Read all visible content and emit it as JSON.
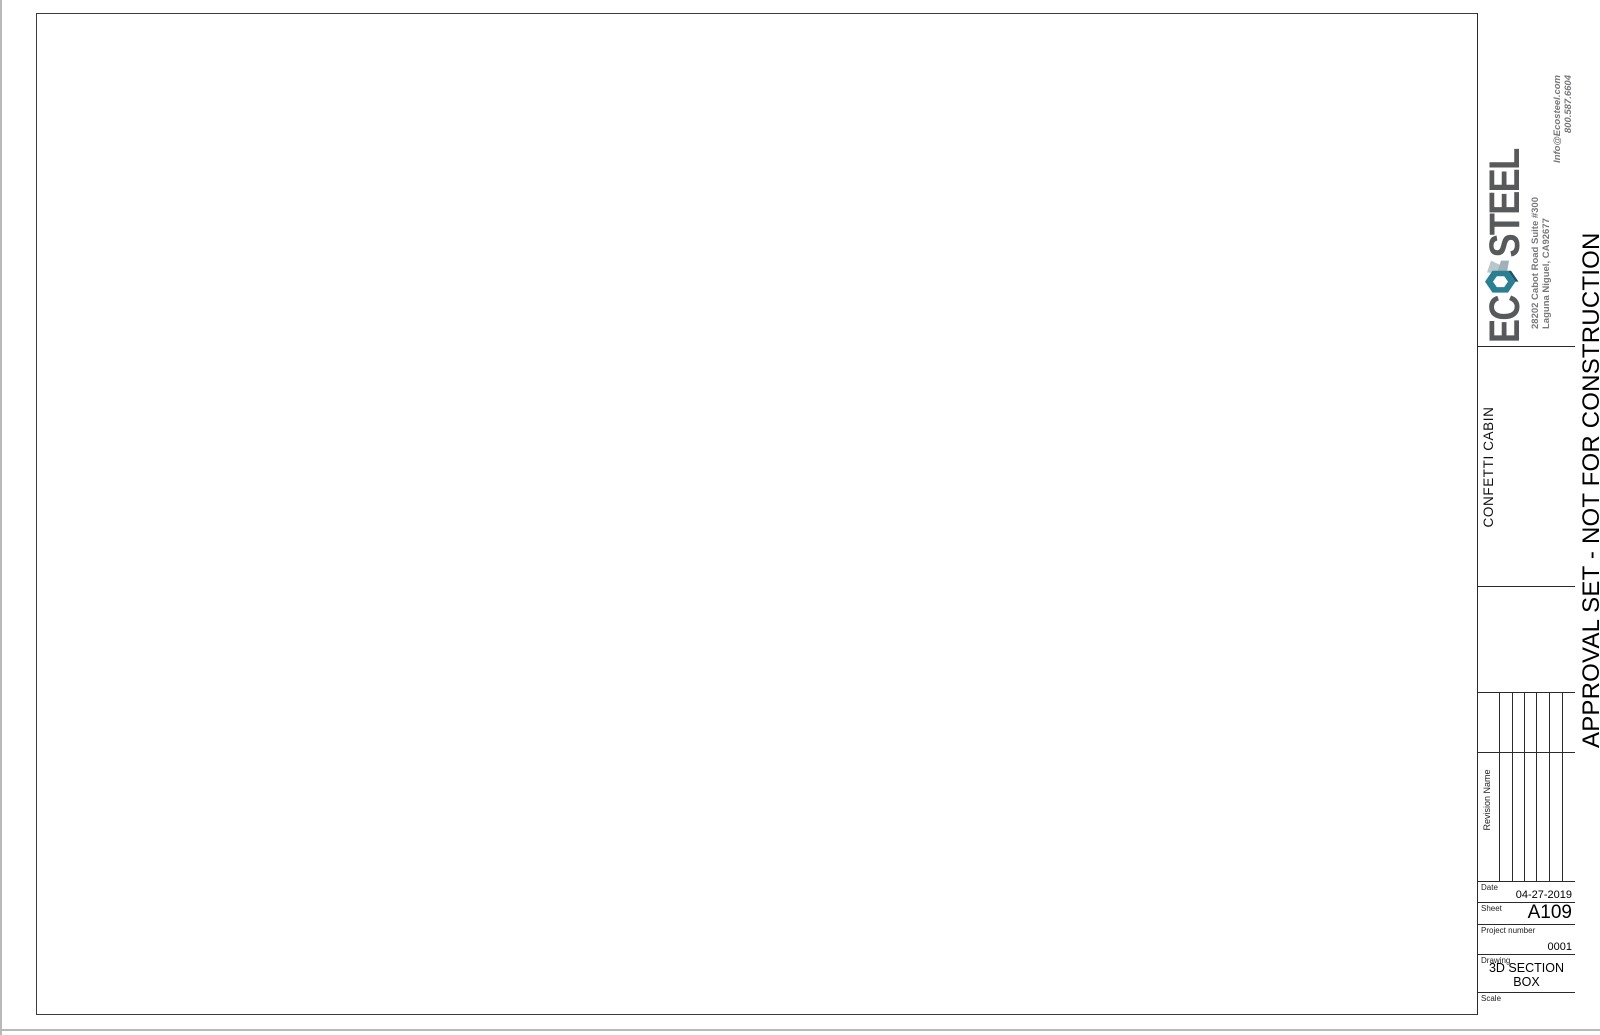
{
  "title_block": {
    "brand": {
      "name_left": "EC",
      "name_right": "STEEL",
      "address_line1": "28202 Cabot Road Suite #300",
      "address_line2": "Laguna Niguel, CA92677",
      "contact_line1": "Info@Ecosteel.com",
      "contact_line2": "800.587.6604"
    },
    "project_name": "CONFETTI CABIN",
    "revision_header": "Revision Name",
    "fields": {
      "date_label": "Date",
      "date_value": "04-27-2019",
      "sheet_label": "Sheet",
      "sheet_value": "A109",
      "project_number_label": "Project number",
      "project_number_value": "0001",
      "drawing_label": "Drawing",
      "drawing_value": "3D SECTION BOX",
      "scale_label": "Scale",
      "scale_value": ""
    }
  },
  "banner": {
    "text": "APPROVAL SET - NOT FOR CONSTRUCTION"
  },
  "icons": {
    "logo_hexagon": "hexagon-nut-logo-icon"
  },
  "colors": {
    "accent_teal": "#2a7f93",
    "accent_teal_dark": "#17556b",
    "steel_gray": "#b9c6cb",
    "logo_text": "#58595b",
    "muted_text": "#77787b",
    "line": "#3a3a3a",
    "light_line": "#8a8a8a",
    "cut_black": "#000000",
    "shade_gray": "#dedede"
  }
}
